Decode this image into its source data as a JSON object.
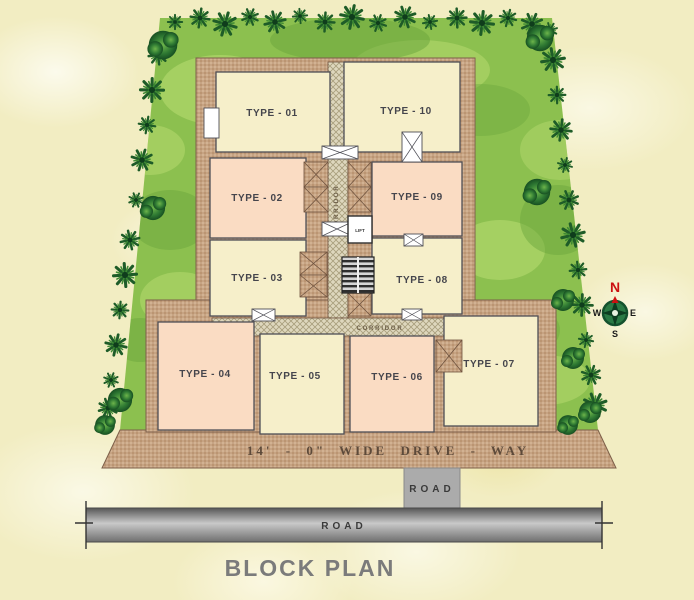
{
  "title": "BLOCK PLAN",
  "units": [
    {
      "label": "TYPE - 01",
      "fill": "cream"
    },
    {
      "label": "TYPE - 02",
      "fill": "peach"
    },
    {
      "label": "TYPE - 03",
      "fill": "cream"
    },
    {
      "label": "TYPE - 04",
      "fill": "peach"
    },
    {
      "label": "TYPE - 05",
      "fill": "cream"
    },
    {
      "label": "TYPE - 06",
      "fill": "peach"
    },
    {
      "label": "TYPE - 07",
      "fill": "cream"
    },
    {
      "label": "TYPE - 08",
      "fill": "cream"
    },
    {
      "label": "TYPE - 09",
      "fill": "peach"
    },
    {
      "label": "TYPE - 10",
      "fill": "cream"
    }
  ],
  "corridor": {
    "vertical_label": "CORRIDOR",
    "horizontal_label": "CORRIDOR"
  },
  "core": {
    "lift_label": "LIFT"
  },
  "driveway": {
    "label": "14' - 0\" WIDE DRIVE - WAY"
  },
  "roads": {
    "stub_label": "ROAD",
    "main_label": "ROAD"
  },
  "compass": {
    "north": "N",
    "east": "E",
    "south": "S",
    "west": "W"
  },
  "colors": {
    "cream": "#f6efca",
    "peach": "#fadcc3",
    "plot_brown": "#c6a383",
    "grass_green": "#8cc04f",
    "tree_green": "#1e5c28",
    "road_gray": "#9a9a9a",
    "north_red": "#cc1111",
    "text_dark": "#45454c",
    "driveway_text": "#5d4a3a",
    "title_gray": "#7b7b7b"
  }
}
